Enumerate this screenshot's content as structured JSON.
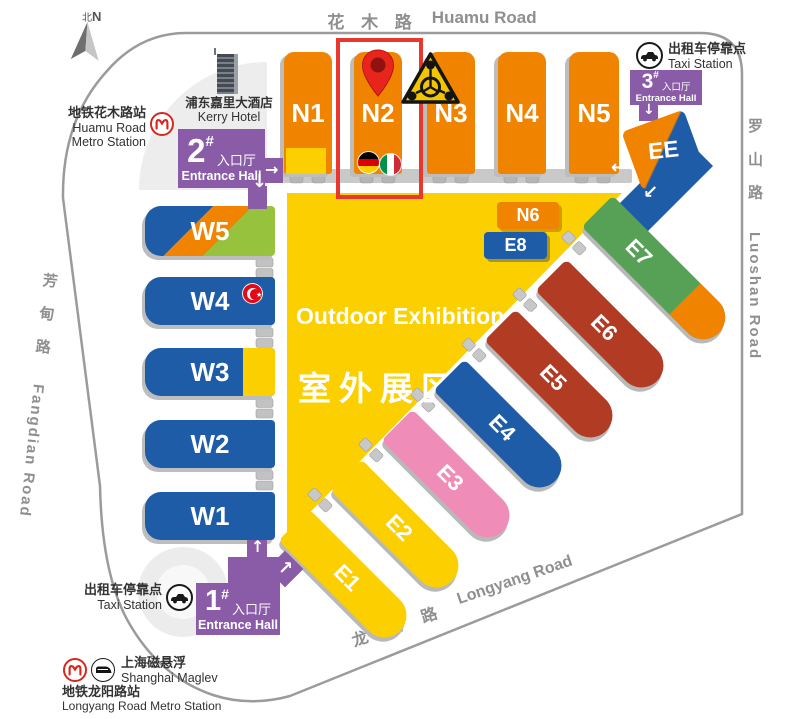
{
  "compass": {
    "zh": "北",
    "en": "N"
  },
  "roads": {
    "huamu_zh": "花 木 路",
    "huamu_en": "Huamu Road",
    "luoshan_zh": "罗 山 路",
    "luoshan_en": "Luoshan Road",
    "fangdian_zh": "芳 甸 路",
    "fangdian_en": "Fangdian Road",
    "longyang_zh": "龙 阳 路",
    "longyang_en": "Longyang Road"
  },
  "halls": {
    "n": [
      "N1",
      "N2",
      "N3",
      "N4",
      "N5"
    ],
    "n6": "N6",
    "e8": "E8",
    "ee": "EE",
    "w": [
      "W5",
      "W4",
      "W3",
      "W2",
      "W1"
    ],
    "e": [
      "E1",
      "E2",
      "E3",
      "E4",
      "E5",
      "E6",
      "E7"
    ]
  },
  "outdoor": {
    "en": "Outdoor Exhibition Area",
    "zh": "室外展区"
  },
  "entrances": {
    "no1": {
      "num": "1",
      "hash": "#",
      "zh": "入口厅",
      "en": "Entrance Hall"
    },
    "no2": {
      "num": "2",
      "hash": "#",
      "zh": "入口厅",
      "en": "Entrance Hall"
    },
    "no3": {
      "num": "3",
      "hash": "#",
      "zh": "入口厅",
      "en": "Entrance Hall"
    }
  },
  "stations": {
    "kerry": {
      "zh": "浦东嘉里大酒店",
      "en": "Kerry Hotel"
    },
    "huamu_metro": {
      "zh": "地铁花木路站",
      "en1": "Huamu Road",
      "en2": "Metro Station"
    },
    "taxi_ne": {
      "zh": "出租车停靠点",
      "en": "Taxi Station"
    },
    "taxi_sw": {
      "zh": "出租车停靠点",
      "en": "Taxi Station"
    },
    "maglev": {
      "zh": "上海磁悬浮",
      "en": "Shanghai Maglev"
    },
    "longyang_metro": {
      "zh": "地铁龙阳路站",
      "en": "Longyang Road Metro Station"
    }
  },
  "icons": {
    "arrow_right": "→",
    "arrow_down": "↓",
    "arrow_up": "↑",
    "arrow_left": "←",
    "arrow_up_right": "↗",
    "arrow_down_left": "↙"
  },
  "colors": {
    "orange": "#F08300",
    "blue": "#1E5CA8",
    "yellow": "#FCD000",
    "purple": "#8A5CA8",
    "pink": "#F08CB8",
    "dark_red": "#B23B23",
    "green": "#56A155",
    "light_green": "#96C23D",
    "highlight_red": "#E8372C",
    "shadow_gray": "#B5B5B5"
  }
}
